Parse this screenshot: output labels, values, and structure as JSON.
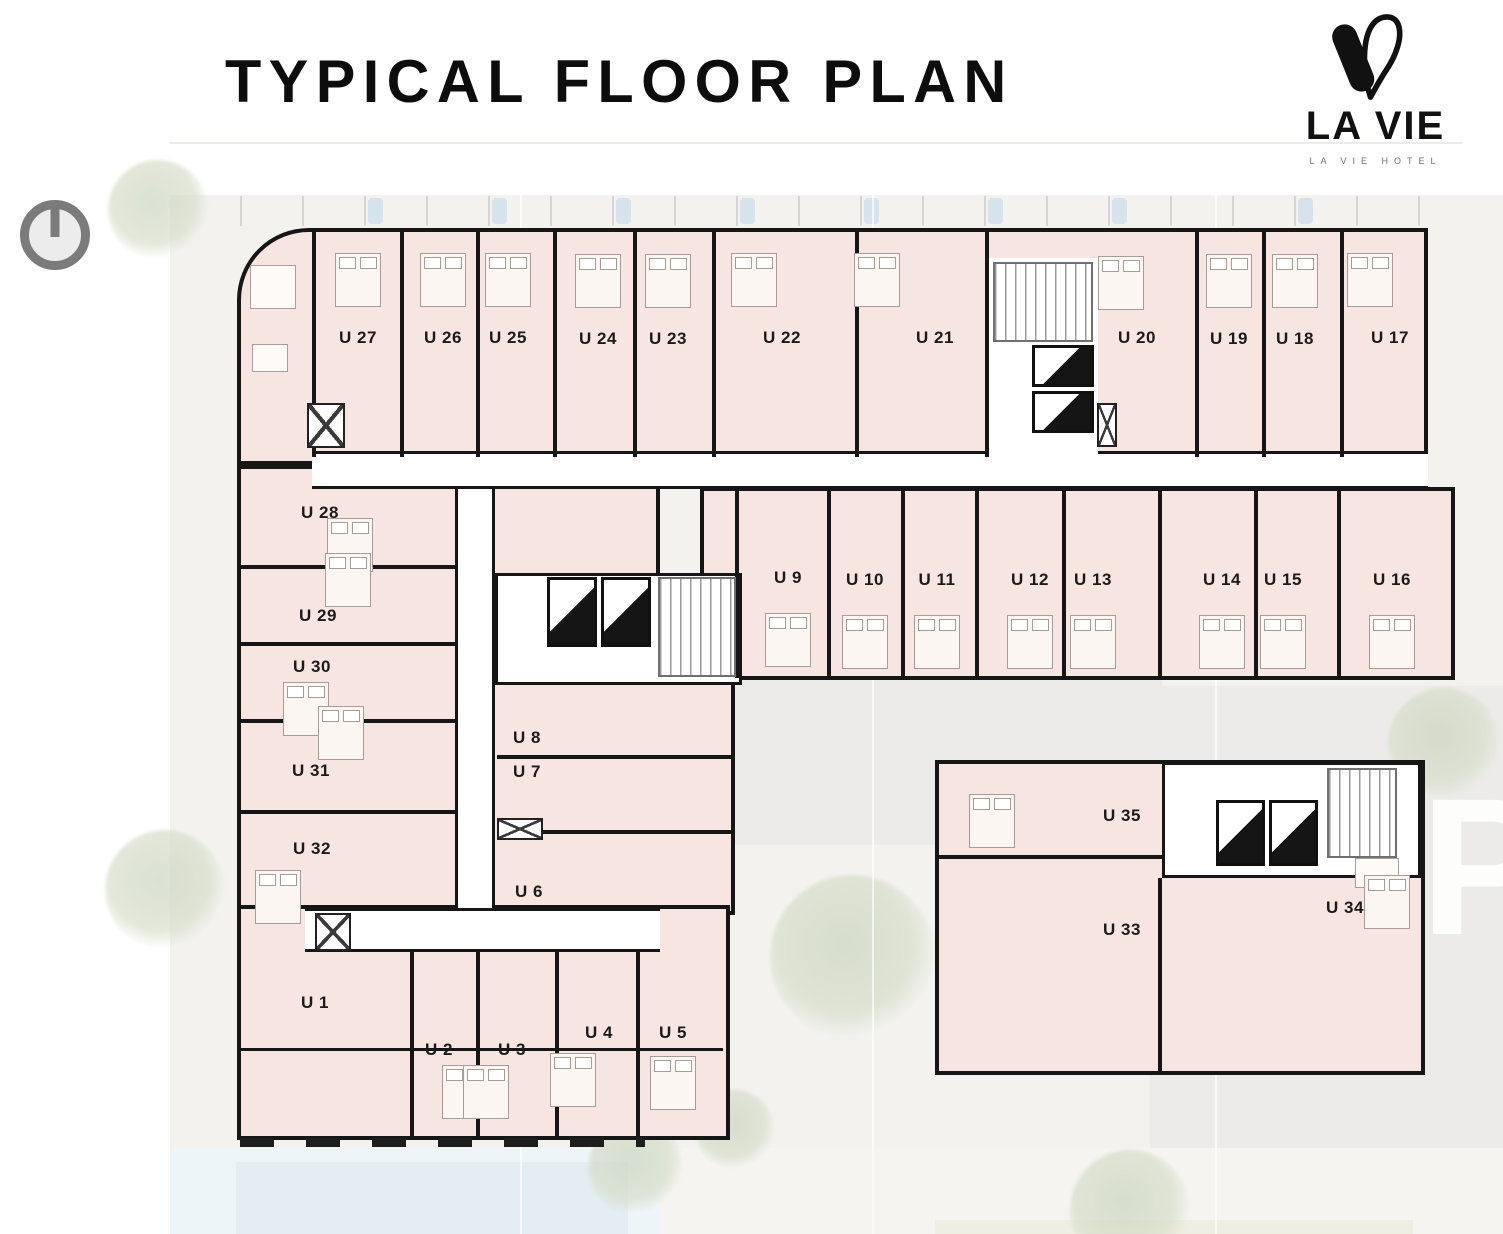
{
  "header": {
    "title": "TYPICAL FLOOR PLAN"
  },
  "logo": {
    "name": "LA VIE",
    "subtitle": "LA VIE HOTEL"
  },
  "site": {
    "parking_label": "P"
  },
  "colors": {
    "room_fill": "#f6e5e1",
    "wall": "#161616",
    "corridor": "#ffffff",
    "site_background": "#f3f2ef",
    "pool": "#e3edf2",
    "tree": "#ccd5c0",
    "logo_black": "#111111"
  },
  "plan": {
    "units": [
      {
        "label": "U 27",
        "x": 358,
        "y": 338,
        "bed": [
          0,
          -58
        ]
      },
      {
        "label": "U 26",
        "x": 443,
        "y": 338,
        "bed": [
          0,
          -58
        ]
      },
      {
        "label": "U 25",
        "x": 508,
        "y": 338,
        "bed": [
          0,
          -58
        ]
      },
      {
        "label": "U 24",
        "x": 598,
        "y": 339,
        "bed": [
          0,
          -58
        ]
      },
      {
        "label": "U 23",
        "x": 668,
        "y": 339,
        "bed": [
          0,
          -58
        ]
      },
      {
        "label": "U 22",
        "x": 782,
        "y": 338,
        "bed": [
          -28,
          -58
        ]
      },
      {
        "label": "U 21",
        "x": 935,
        "y": 338,
        "bed": [
          -58,
          -58
        ]
      },
      {
        "label": "U 20",
        "x": 1137,
        "y": 338,
        "bed": [
          -16,
          -55
        ]
      },
      {
        "label": "U 19",
        "x": 1229,
        "y": 339,
        "bed": [
          0,
          -58
        ]
      },
      {
        "label": "U 18",
        "x": 1295,
        "y": 339,
        "bed": [
          0,
          -58
        ]
      },
      {
        "label": "U 17",
        "x": 1390,
        "y": 338,
        "bed": [
          -20,
          -58
        ]
      },
      {
        "label": "U 9",
        "x": 788,
        "y": 578,
        "bed": [
          0,
          62
        ]
      },
      {
        "label": "U 10",
        "x": 865,
        "y": 580,
        "bed": [
          0,
          62
        ]
      },
      {
        "label": "U 11",
        "x": 937,
        "y": 580,
        "bed": [
          0,
          62
        ]
      },
      {
        "label": "U 12",
        "x": 1030,
        "y": 580,
        "bed": [
          0,
          62
        ]
      },
      {
        "label": "U 13",
        "x": 1093,
        "y": 580,
        "bed": [
          0,
          62
        ]
      },
      {
        "label": "U 14",
        "x": 1222,
        "y": 580,
        "bed": [
          0,
          62
        ]
      },
      {
        "label": "U 15",
        "x": 1283,
        "y": 580,
        "bed": [
          0,
          62
        ]
      },
      {
        "label": "U 16",
        "x": 1392,
        "y": 580,
        "bed": [
          0,
          62
        ]
      },
      {
        "label": "U 28",
        "x": 320,
        "y": 513,
        "bed": [
          30,
          32
        ]
      },
      {
        "label": "U 29",
        "x": 318,
        "y": 616,
        "bed": [
          30,
          -36
        ]
      },
      {
        "label": "U 30",
        "x": 312,
        "y": 667,
        "bed": [
          -6,
          42
        ]
      },
      {
        "label": "U 31",
        "x": 311,
        "y": 771,
        "bed": [
          30,
          -38
        ]
      },
      {
        "label": "U 32",
        "x": 312,
        "y": 849,
        "bed": [
          -34,
          48
        ]
      },
      {
        "label": "U 1",
        "x": 315,
        "y": 1003
      },
      {
        "label": "U 2",
        "x": 439,
        "y": 1050,
        "bed": [
          26,
          42
        ]
      },
      {
        "label": "U 3",
        "x": 512,
        "y": 1050,
        "bed": [
          -26,
          42
        ]
      },
      {
        "label": "U 4",
        "x": 599,
        "y": 1033,
        "bed": [
          -26,
          47
        ]
      },
      {
        "label": "U 5",
        "x": 673,
        "y": 1033,
        "bed": [
          0,
          50
        ]
      },
      {
        "label": "U 8",
        "x": 527,
        "y": 738
      },
      {
        "label": "U 7",
        "x": 527,
        "y": 772
      },
      {
        "label": "U 6",
        "x": 529,
        "y": 892
      },
      {
        "label": "U 35",
        "x": 1122,
        "y": 816,
        "bed": [
          -130,
          5
        ]
      },
      {
        "label": "U 33",
        "x": 1122,
        "y": 930
      },
      {
        "label": "U 34",
        "x": 1345,
        "y": 908,
        "bed": [
          42,
          -6
        ]
      }
    ],
    "walls": [
      {
        "x": 312,
        "y": 232,
        "w": 4,
        "h": 225
      },
      {
        "x": 400,
        "y": 232,
        "w": 4,
        "h": 225
      },
      {
        "x": 476,
        "y": 232,
        "w": 4,
        "h": 225
      },
      {
        "x": 553,
        "y": 232,
        "w": 4,
        "h": 225
      },
      {
        "x": 633,
        "y": 232,
        "w": 4,
        "h": 225
      },
      {
        "x": 712,
        "y": 232,
        "w": 4,
        "h": 225
      },
      {
        "x": 855,
        "y": 232,
        "w": 4,
        "h": 225
      },
      {
        "x": 985,
        "y": 232,
        "w": 4,
        "h": 225
      },
      {
        "x": 1195,
        "y": 232,
        "w": 4,
        "h": 225
      },
      {
        "x": 1262,
        "y": 232,
        "w": 4,
        "h": 225
      },
      {
        "x": 1340,
        "y": 232,
        "w": 4,
        "h": 225
      },
      {
        "x": 735,
        "y": 491,
        "w": 4,
        "h": 187
      },
      {
        "x": 827,
        "y": 491,
        "w": 4,
        "h": 187
      },
      {
        "x": 901,
        "y": 491,
        "w": 4,
        "h": 187
      },
      {
        "x": 975,
        "y": 491,
        "w": 4,
        "h": 187
      },
      {
        "x": 1062,
        "y": 491,
        "w": 4,
        "h": 187
      },
      {
        "x": 1158,
        "y": 491,
        "w": 4,
        "h": 187
      },
      {
        "x": 1254,
        "y": 491,
        "w": 4,
        "h": 187
      },
      {
        "x": 1337,
        "y": 491,
        "w": 4,
        "h": 187
      },
      {
        "x": 241,
        "y": 565,
        "w": 216,
        "h": 4
      },
      {
        "x": 241,
        "y": 642,
        "w": 216,
        "h": 4
      },
      {
        "x": 241,
        "y": 719,
        "w": 216,
        "h": 4
      },
      {
        "x": 241,
        "y": 810,
        "w": 216,
        "h": 4
      },
      {
        "x": 497,
        "y": 755,
        "w": 235,
        "h": 4
      },
      {
        "x": 497,
        "y": 830,
        "w": 235,
        "h": 4
      },
      {
        "x": 410,
        "y": 952,
        "w": 4,
        "h": 185
      },
      {
        "x": 476,
        "y": 952,
        "w": 4,
        "h": 185
      },
      {
        "x": 555,
        "y": 952,
        "w": 4,
        "h": 185
      },
      {
        "x": 636,
        "y": 952,
        "w": 4,
        "h": 185
      },
      {
        "x": 241,
        "y": 1048,
        "w": 482,
        "h": 3
      },
      {
        "x": 1158,
        "y": 878,
        "w": 4,
        "h": 194
      },
      {
        "x": 939,
        "y": 855,
        "w": 223,
        "h": 4
      }
    ],
    "elevators": [
      {
        "x": 547,
        "y": 577,
        "w": 50,
        "h": 70
      },
      {
        "x": 601,
        "y": 577,
        "w": 50,
        "h": 70
      },
      {
        "x": 1032,
        "y": 345,
        "w": 62,
        "h": 42
      },
      {
        "x": 1032,
        "y": 391,
        "w": 62,
        "h": 42
      },
      {
        "x": 1216,
        "y": 800,
        "w": 49,
        "h": 66
      },
      {
        "x": 1269,
        "y": 800,
        "w": 49,
        "h": 66
      }
    ],
    "stairs": [
      {
        "x": 658,
        "y": 577,
        "w": 78,
        "h": 100
      },
      {
        "x": 993,
        "y": 262,
        "w": 100,
        "h": 80
      },
      {
        "x": 1327,
        "y": 768,
        "w": 70,
        "h": 90
      }
    ],
    "shafts": [
      {
        "x": 307,
        "y": 403,
        "w": 38,
        "h": 45
      },
      {
        "x": 315,
        "y": 913,
        "w": 36,
        "h": 38
      },
      {
        "x": 497,
        "y": 818,
        "w": 46,
        "h": 22
      },
      {
        "x": 1097,
        "y": 403,
        "w": 20,
        "h": 44
      }
    ],
    "cars": [
      368,
      492,
      616,
      740,
      864,
      988,
      1112,
      1298
    ],
    "trees": [
      {
        "x": 105,
        "y": 830,
        "s": 120
      },
      {
        "x": 108,
        "y": 160,
        "s": 100
      },
      {
        "x": 1388,
        "y": 688,
        "s": 112
      },
      {
        "x": 770,
        "y": 875,
        "s": 165
      },
      {
        "x": 695,
        "y": 1090,
        "s": 80
      },
      {
        "x": 588,
        "y": 1120,
        "s": 95
      },
      {
        "x": 1070,
        "y": 1150,
        "s": 120
      }
    ],
    "gridlines": [
      520,
      872,
      1215
    ]
  }
}
